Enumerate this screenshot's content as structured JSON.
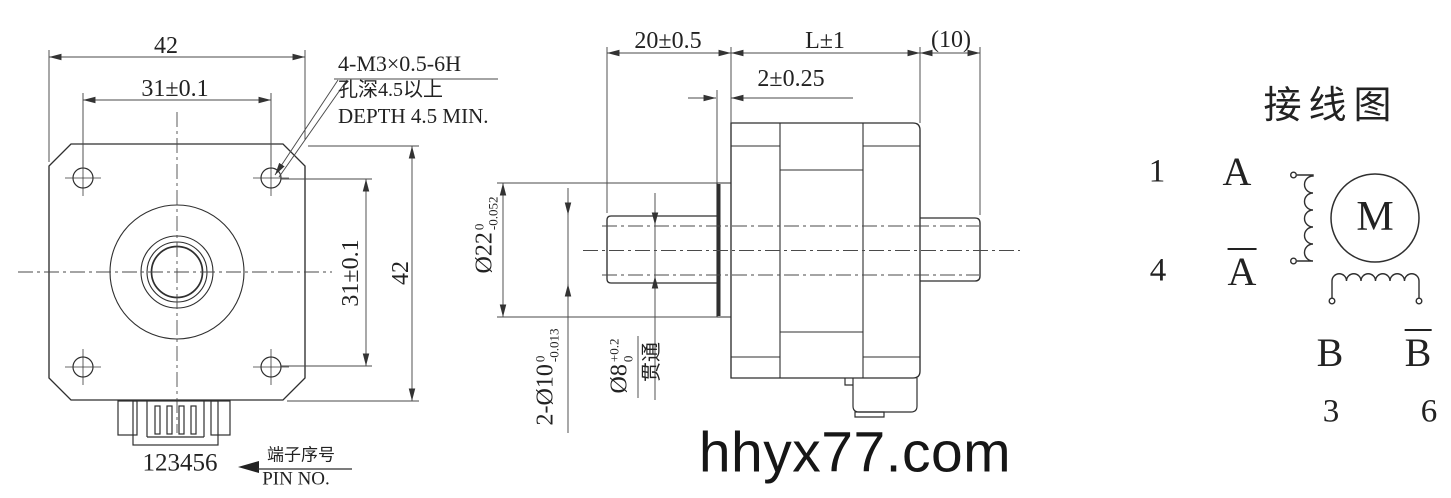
{
  "colors": {
    "background": "#ffffff",
    "line": "#2f2f2f",
    "dim_line": "#4a4a4a",
    "text": "#222222"
  },
  "front_view": {
    "dim_width_top": "42",
    "dim_holes_top": "31±0.1",
    "dim_holes_right": "31±0.1",
    "dim_height_right": "42",
    "thread_note": {
      "line1": "4-M3×0.5-6H",
      "line2": "孔深4.5以上",
      "line3": "DEPTH 4.5 MIN."
    },
    "pin_numbers": "123456",
    "pin_label_cn": "端子序号",
    "pin_label_en": "PIN NO."
  },
  "side_view": {
    "dim_shaft_length": "20±0.5",
    "dim_body_length": "L±1",
    "dim_rear_shaft": "(10)",
    "dim_pilot_depth": "2±0.25",
    "dim_pilot_dia": {
      "base": "Ø22",
      "tol_upper": "0",
      "tol_lower": "-0.052"
    },
    "dim_shaft_dia": {
      "base": "2-Ø10",
      "tol_upper": "0",
      "tol_lower": "-0.013"
    },
    "dim_bore_dia": {
      "base": "Ø8",
      "tol_upper": "+0.2",
      "tol_lower": "0"
    },
    "bore_through_label": "贯通"
  },
  "wiring_diagram": {
    "title": "接线图",
    "terminal_1": "1",
    "terminal_4": "4",
    "terminal_3": "3",
    "terminal_6": "6",
    "phase_a": "A",
    "phase_a_bar": "A",
    "phase_b": "B",
    "phase_b_bar": "B",
    "motor_symbol": "M"
  },
  "watermark": "hhyx77.com"
}
